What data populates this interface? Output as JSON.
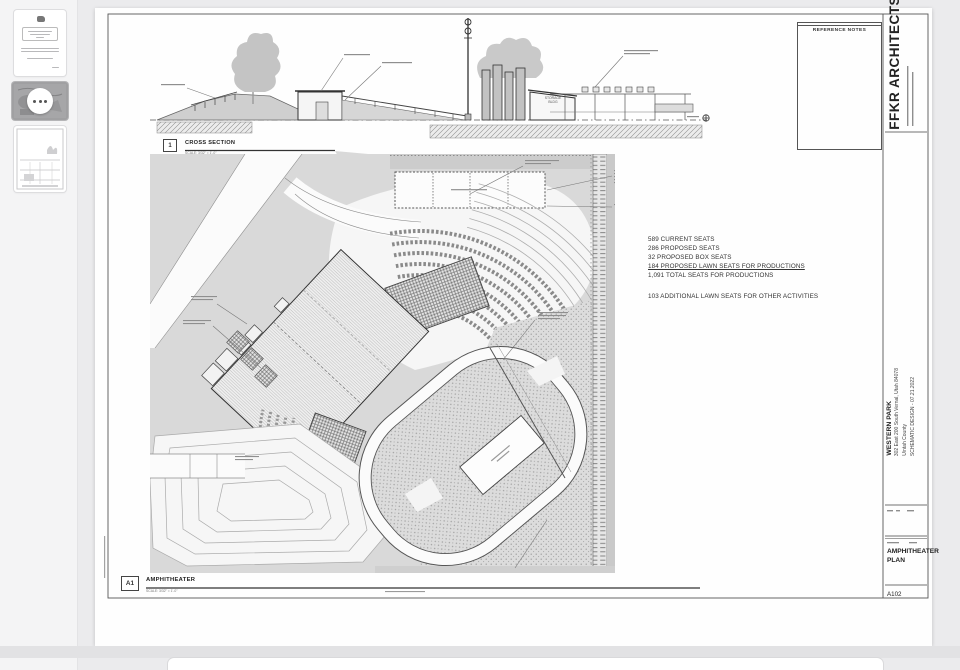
{
  "sidebar": {
    "thumbnails": [
      {
        "name": "cover-text-page",
        "selected": false
      },
      {
        "name": "amphitheater-plan-page",
        "selected": true
      },
      {
        "name": "site-drawing-page",
        "selected": false
      }
    ]
  },
  "sheet": {
    "reference_notes_title": "REFERENCE NOTES",
    "firm_name": "FFKR ARCHITECTS",
    "titleblock": {
      "project_name": "WESTERN PARK",
      "project_address": "302 East 200 South Vernal, Utah 84078",
      "project_county": "Uintah County",
      "phase_line": "SCHEMATIC DESIGN - 07.21.2022",
      "sheet_title_line1": "AMPHITHEATER",
      "sheet_title_line2": "PLAN",
      "sheet_number": "A102"
    },
    "views": {
      "section": {
        "tag": "1",
        "title": "CROSS SECTION",
        "scale": "SCALE:  3/32\" = 1'-0\""
      },
      "plan": {
        "tag": "A1",
        "title": "AMPHITHEATER",
        "scale": "SCALE:  3/32\" = 1'-0\""
      }
    },
    "plan_labels": {
      "storage_line1": "STORAGE",
      "storage_line2": "BLDG"
    },
    "seat_summary": {
      "lines": [
        "589 CURRENT SEATS",
        "286 PROPOSED SEATS",
        "32 PROPOSED BOX SEATS",
        "184 PROPOSED LAWN SEATS FOR PRODUCTIONS",
        "1,091 TOTAL SEATS FOR PRODUCTIONS"
      ],
      "additional_line": "103 ADDITIONAL LAWN SEATS FOR OTHER ACTIVITIES"
    }
  }
}
